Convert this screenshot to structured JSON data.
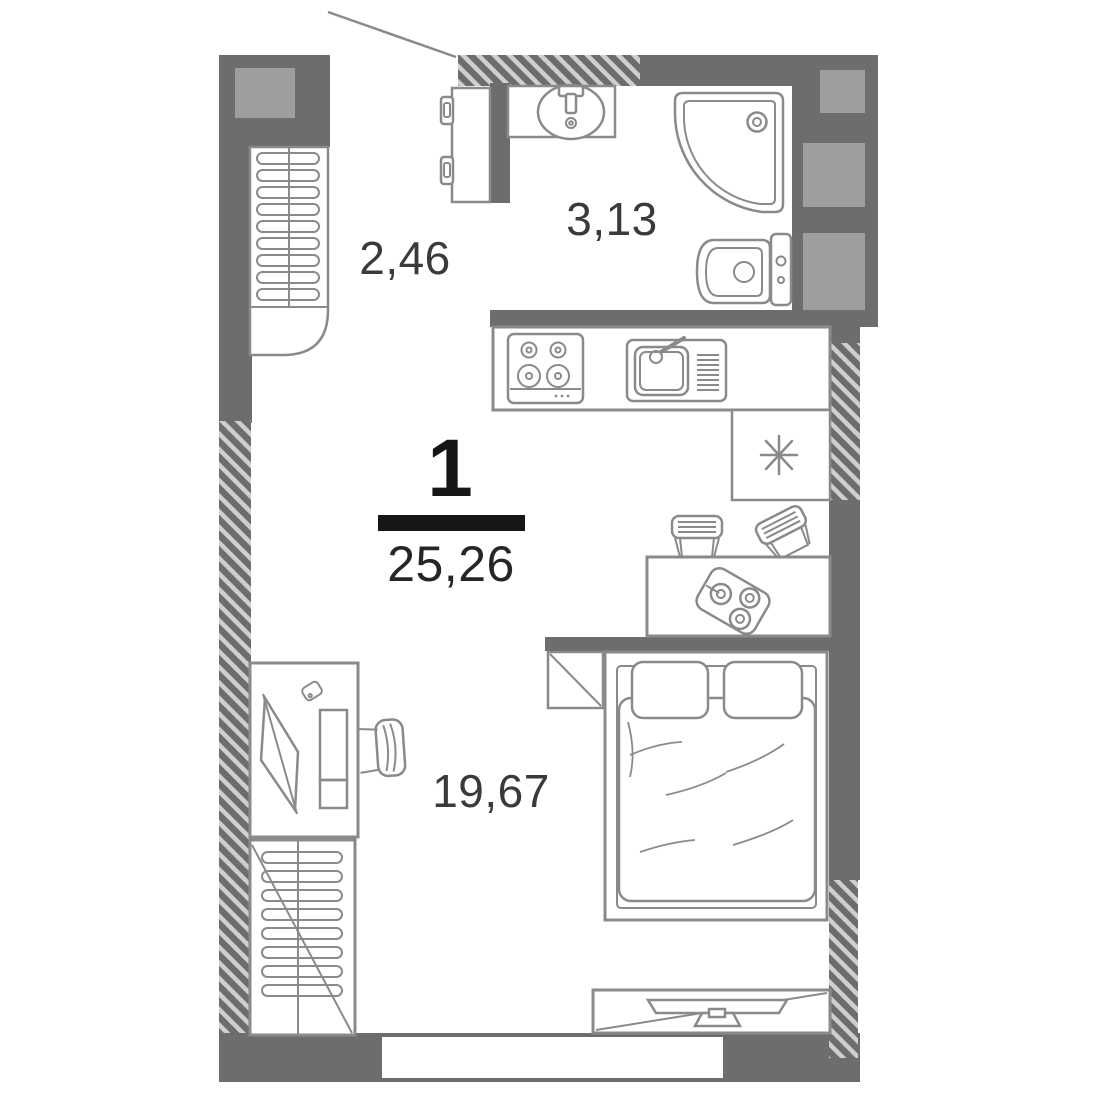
{
  "plan": {
    "rooms_count": "1",
    "total_area": "25,26",
    "areas": {
      "hallway": "2,46",
      "bathroom": "3,13",
      "living_room": "19,67"
    }
  },
  "colors": {
    "wall": "#6d6d6d",
    "shaft": "#9e9e9e",
    "furniture_line": "#8a8a8a",
    "hatch_light": "#cfcfcf",
    "label_text": "#3a3a3a",
    "accent": "#161616"
  },
  "symbols": {
    "fridge": "asterisk",
    "entrance_pointer": "leader-line"
  }
}
